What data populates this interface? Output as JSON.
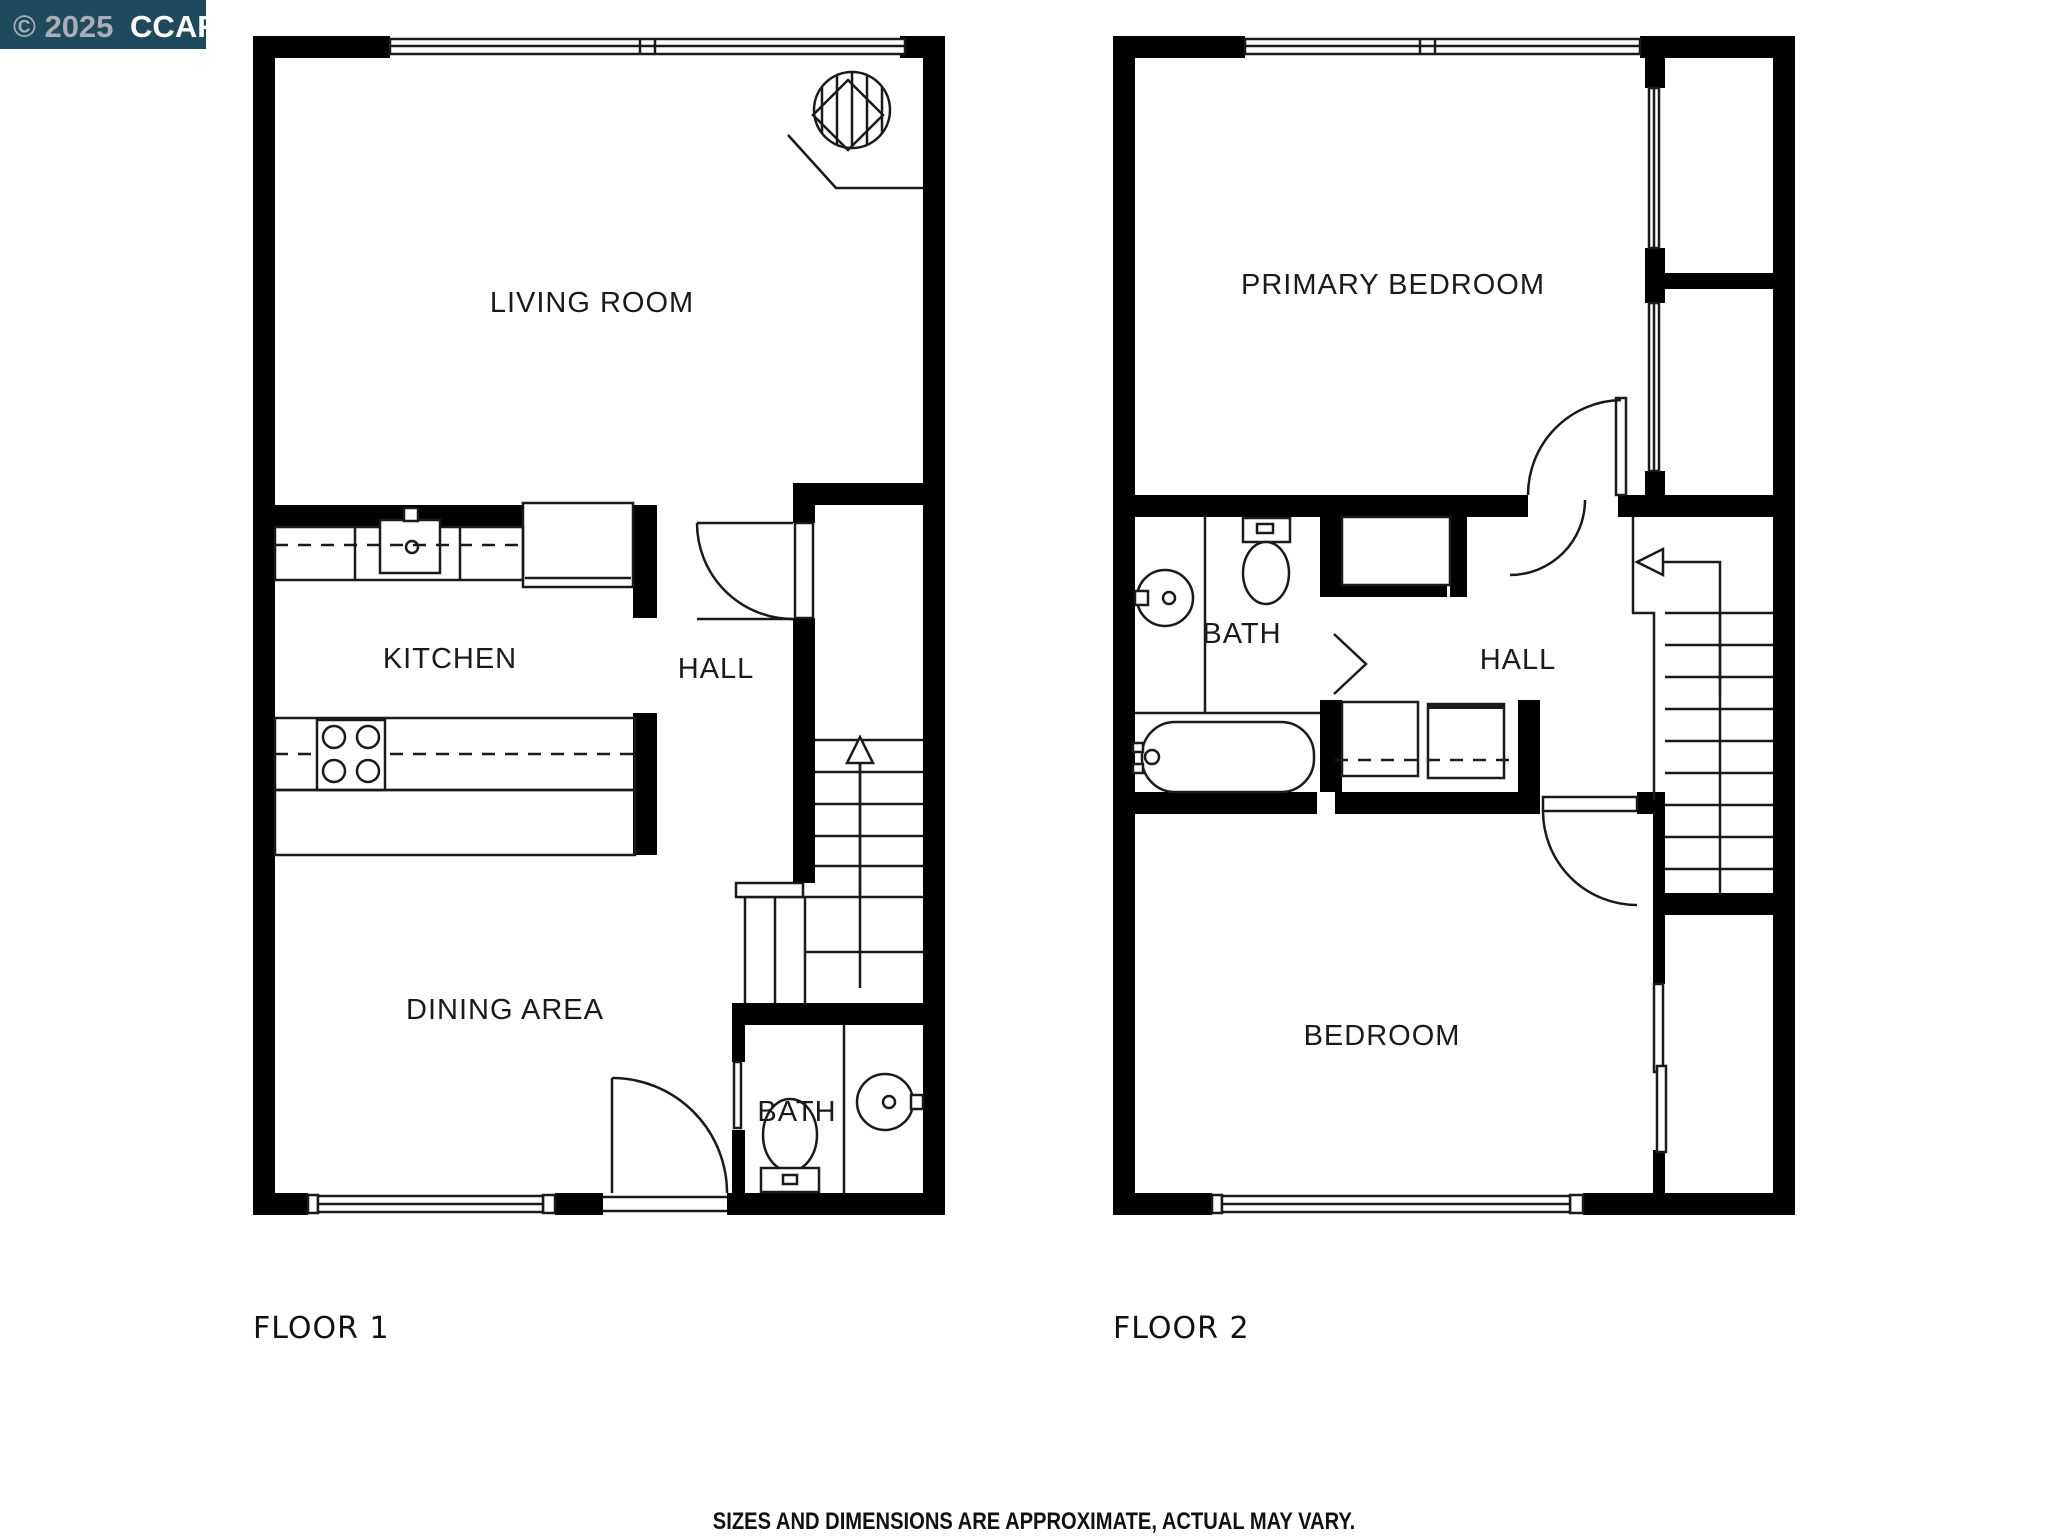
{
  "watermark": {
    "year_part": "© 2025",
    "brand": "CCAR",
    "bg_color": "#1d4a5c",
    "year_color": "#a9aeb6",
    "brand_color": "#ffffff"
  },
  "floors": [
    {
      "label": "FLOOR 1",
      "rooms": [
        {
          "name": "LIVING ROOM"
        },
        {
          "name": "KITCHEN"
        },
        {
          "name": "HALL"
        },
        {
          "name": "DINING AREA"
        },
        {
          "name": "BATH"
        }
      ],
      "features": [
        "fireplace",
        "sliding-windows",
        "refrigerator",
        "kitchen-sink",
        "stove-4-burner",
        "counter-peninsula",
        "entry-door",
        "interior-door",
        "pocket-door",
        "stairs-with-up-arrow",
        "toilet",
        "round-sink"
      ]
    },
    {
      "label": "FLOOR 2",
      "rooms": [
        {
          "name": "PRIMARY BEDROOM"
        },
        {
          "name": "BATH"
        },
        {
          "name": "HALL"
        },
        {
          "name": "BEDROOM"
        }
      ],
      "features": [
        "sliding-windows",
        "round-sink",
        "toilet",
        "bathtub",
        "closet",
        "washer",
        "dryer",
        "stairs-with-down-arrow",
        "bedroom-doors",
        "chase-windows"
      ]
    }
  ],
  "disclaimer": "SIZES AND DIMENSIONS ARE APPROXIMATE, ACTUAL MAY VARY.",
  "colors": {
    "walls": "#000000",
    "lines": "#1a1a1a",
    "background": "#ffffff"
  }
}
